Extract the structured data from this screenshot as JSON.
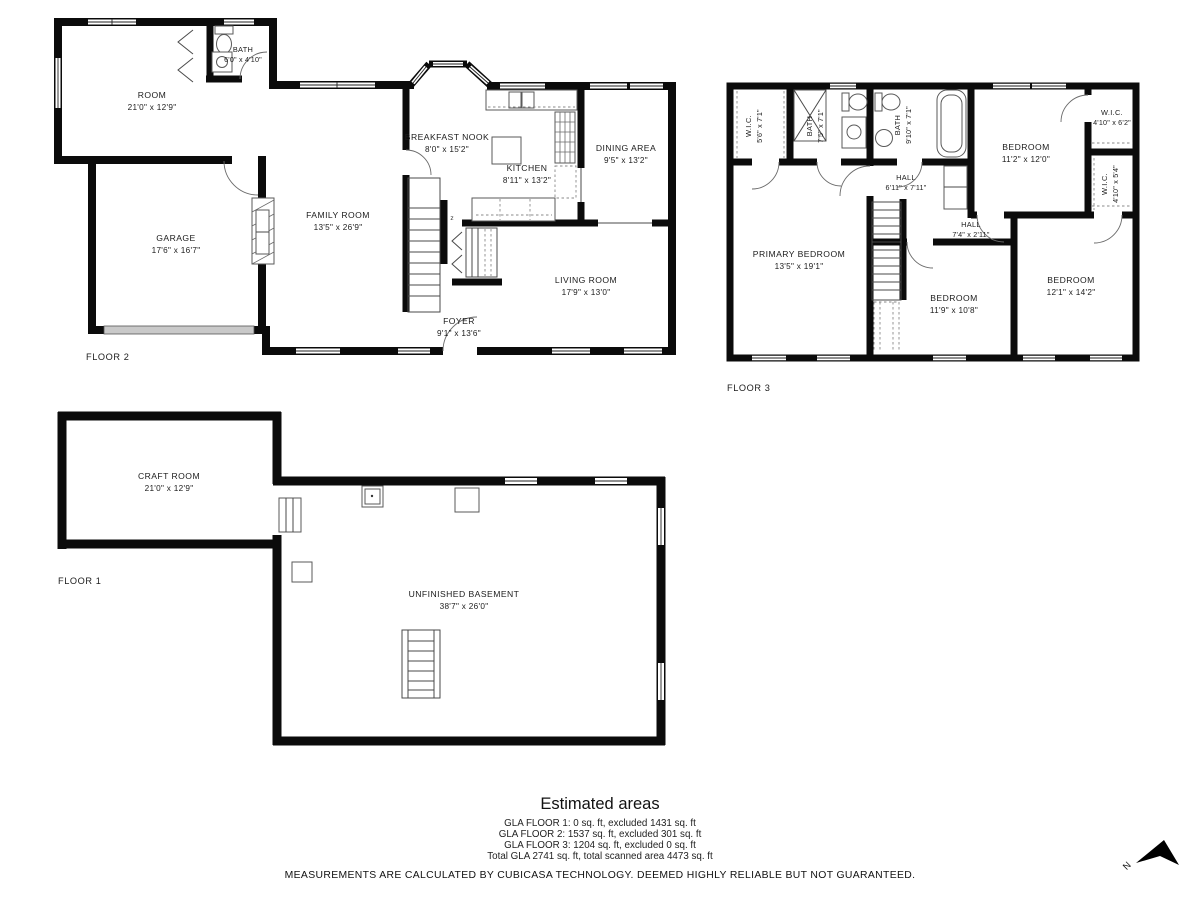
{
  "floors": [
    {
      "label": "FLOOR 2",
      "stair_marker": "z",
      "rooms": [
        {
          "name": "ROOM",
          "dims": "21'0\" x 12'9\""
        },
        {
          "name": "BATH",
          "dims": "6'0\" x 4'10\""
        },
        {
          "name": "GARAGE",
          "dims": "17'6\" x 16'7\""
        },
        {
          "name": "FAMILY ROOM",
          "dims": "13'5\" x 26'9\""
        },
        {
          "name": "BREAKFAST NOOK",
          "dims": "8'0\" x 15'2\""
        },
        {
          "name": "KITCHEN",
          "dims": "8'11\" x 13'2\""
        },
        {
          "name": "DINING AREA",
          "dims": "9'5\" x 13'2\""
        },
        {
          "name": "LIVING ROOM",
          "dims": "17'9\" x 13'0\""
        },
        {
          "name": "FOYER",
          "dims": "9'1\" x 13'6\""
        }
      ]
    },
    {
      "label": "FLOOR 3",
      "rooms": [
        {
          "name": "W.I.C.",
          "dims": "5'6\" x 7'1\""
        },
        {
          "name": "BATH",
          "dims": "7'5\" x 7'1\""
        },
        {
          "name": "BATH",
          "dims": "9'10\" x 7'1\""
        },
        {
          "name": "HALL",
          "dims": "6'11\" x 7'11\""
        },
        {
          "name": "BEDROOM",
          "dims": "11'2\" x 12'0\""
        },
        {
          "name": "W.I.C.",
          "dims": "4'10\" x 6'2\""
        },
        {
          "name": "W.I.C.",
          "dims": "4'10\" x 5'4\""
        },
        {
          "name": "HALL",
          "dims": "7'4\" x 2'11\""
        },
        {
          "name": "PRIMARY BEDROOM",
          "dims": "13'5\" x 19'1\""
        },
        {
          "name": "BEDROOM",
          "dims": "11'9\" x 10'8\""
        },
        {
          "name": "BEDROOM",
          "dims": "12'1\" x 14'2\""
        }
      ]
    },
    {
      "label": "FLOOR 1",
      "rooms": [
        {
          "name": "CRAFT ROOM",
          "dims": "21'0\" x 12'9\""
        },
        {
          "name": "UNFINISHED BASEMENT",
          "dims": "38'7\" x 26'0\""
        }
      ]
    }
  ],
  "estimated_areas": {
    "title": "Estimated areas",
    "lines": [
      "GLA FLOOR 1: 0 sq. ft, excluded 1431 sq. ft",
      "GLA FLOOR 2: 1537 sq. ft, excluded 301 sq. ft",
      "GLA FLOOR 3: 1204 sq. ft, excluded 0 sq. ft",
      "Total GLA 2741 sq. ft, total scanned area 4473 sq. ft"
    ]
  },
  "disclaimer": "MEASUREMENTS ARE CALCULATED BY CUBICASA TECHNOLOGY. DEEMED HIGHLY RELIABLE BUT NOT GUARANTEED.",
  "compass": {
    "north_label": "N"
  },
  "colors": {
    "wall": "#0b0b0b",
    "garage_door_fill": "#c9c9c9"
  }
}
